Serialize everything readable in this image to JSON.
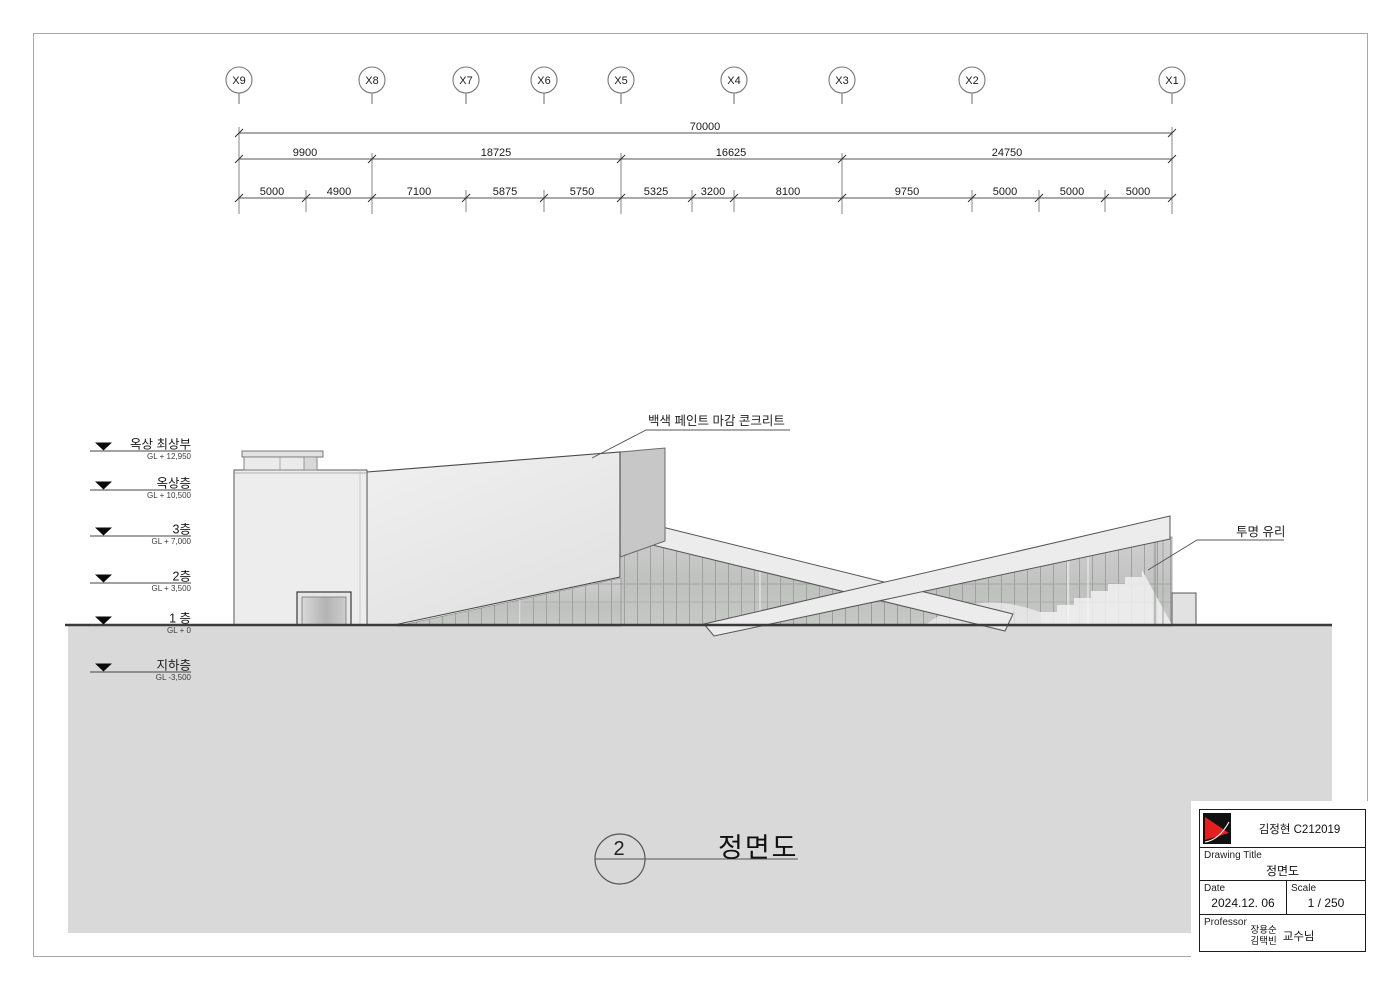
{
  "grid": {
    "labels": [
      "X9",
      "X8",
      "X7",
      "X6",
      "X5",
      "X4",
      "X3",
      "X2",
      "X1"
    ]
  },
  "dims": {
    "total": "70000",
    "level2": [
      "9900",
      "18725",
      "16625",
      "24750"
    ],
    "level3": [
      "5000",
      "4900",
      "7100",
      "5875",
      "5750",
      "5325",
      "3200",
      "8100",
      "9750",
      "5000",
      "5000",
      "5000"
    ]
  },
  "levels": [
    {
      "name": "옥상 최상부",
      "elevation": "GL + 12,950"
    },
    {
      "name": "옥상층",
      "elevation": "GL + 10,500"
    },
    {
      "name": "3층",
      "elevation": "GL + 7,000"
    },
    {
      "name": "2층",
      "elevation": "GL + 3,500"
    },
    {
      "name": "1 층",
      "elevation": "GL + 0"
    },
    {
      "name": "지하층",
      "elevation": "GL -3,500"
    }
  ],
  "annotations": {
    "concrete": "백색 페인트 마감 콘크리트",
    "glass": "투명 유리"
  },
  "view": {
    "number": "2",
    "title": "정면도"
  },
  "title_block": {
    "student": "김정현 C212019",
    "drawing_title_label": "Drawing Title",
    "drawing_title": "정면도",
    "date_label": "Date",
    "date": "2024.12. 06",
    "scale_label": "Scale",
    "scale": "1 / 250",
    "professor_label": "Professor",
    "professor_name_1": "장용순",
    "professor_name_2": "김택빈",
    "professor_suffix": "교수님"
  },
  "colors": {
    "ground": "#d9d9d9",
    "line": "#4a4a4a",
    "wall_light": "#ececec",
    "wall_dark": "#c7c7c7",
    "glass": "#c2c4c2",
    "logo_red": "#e51f1f",
    "logo_black": "#111111"
  }
}
